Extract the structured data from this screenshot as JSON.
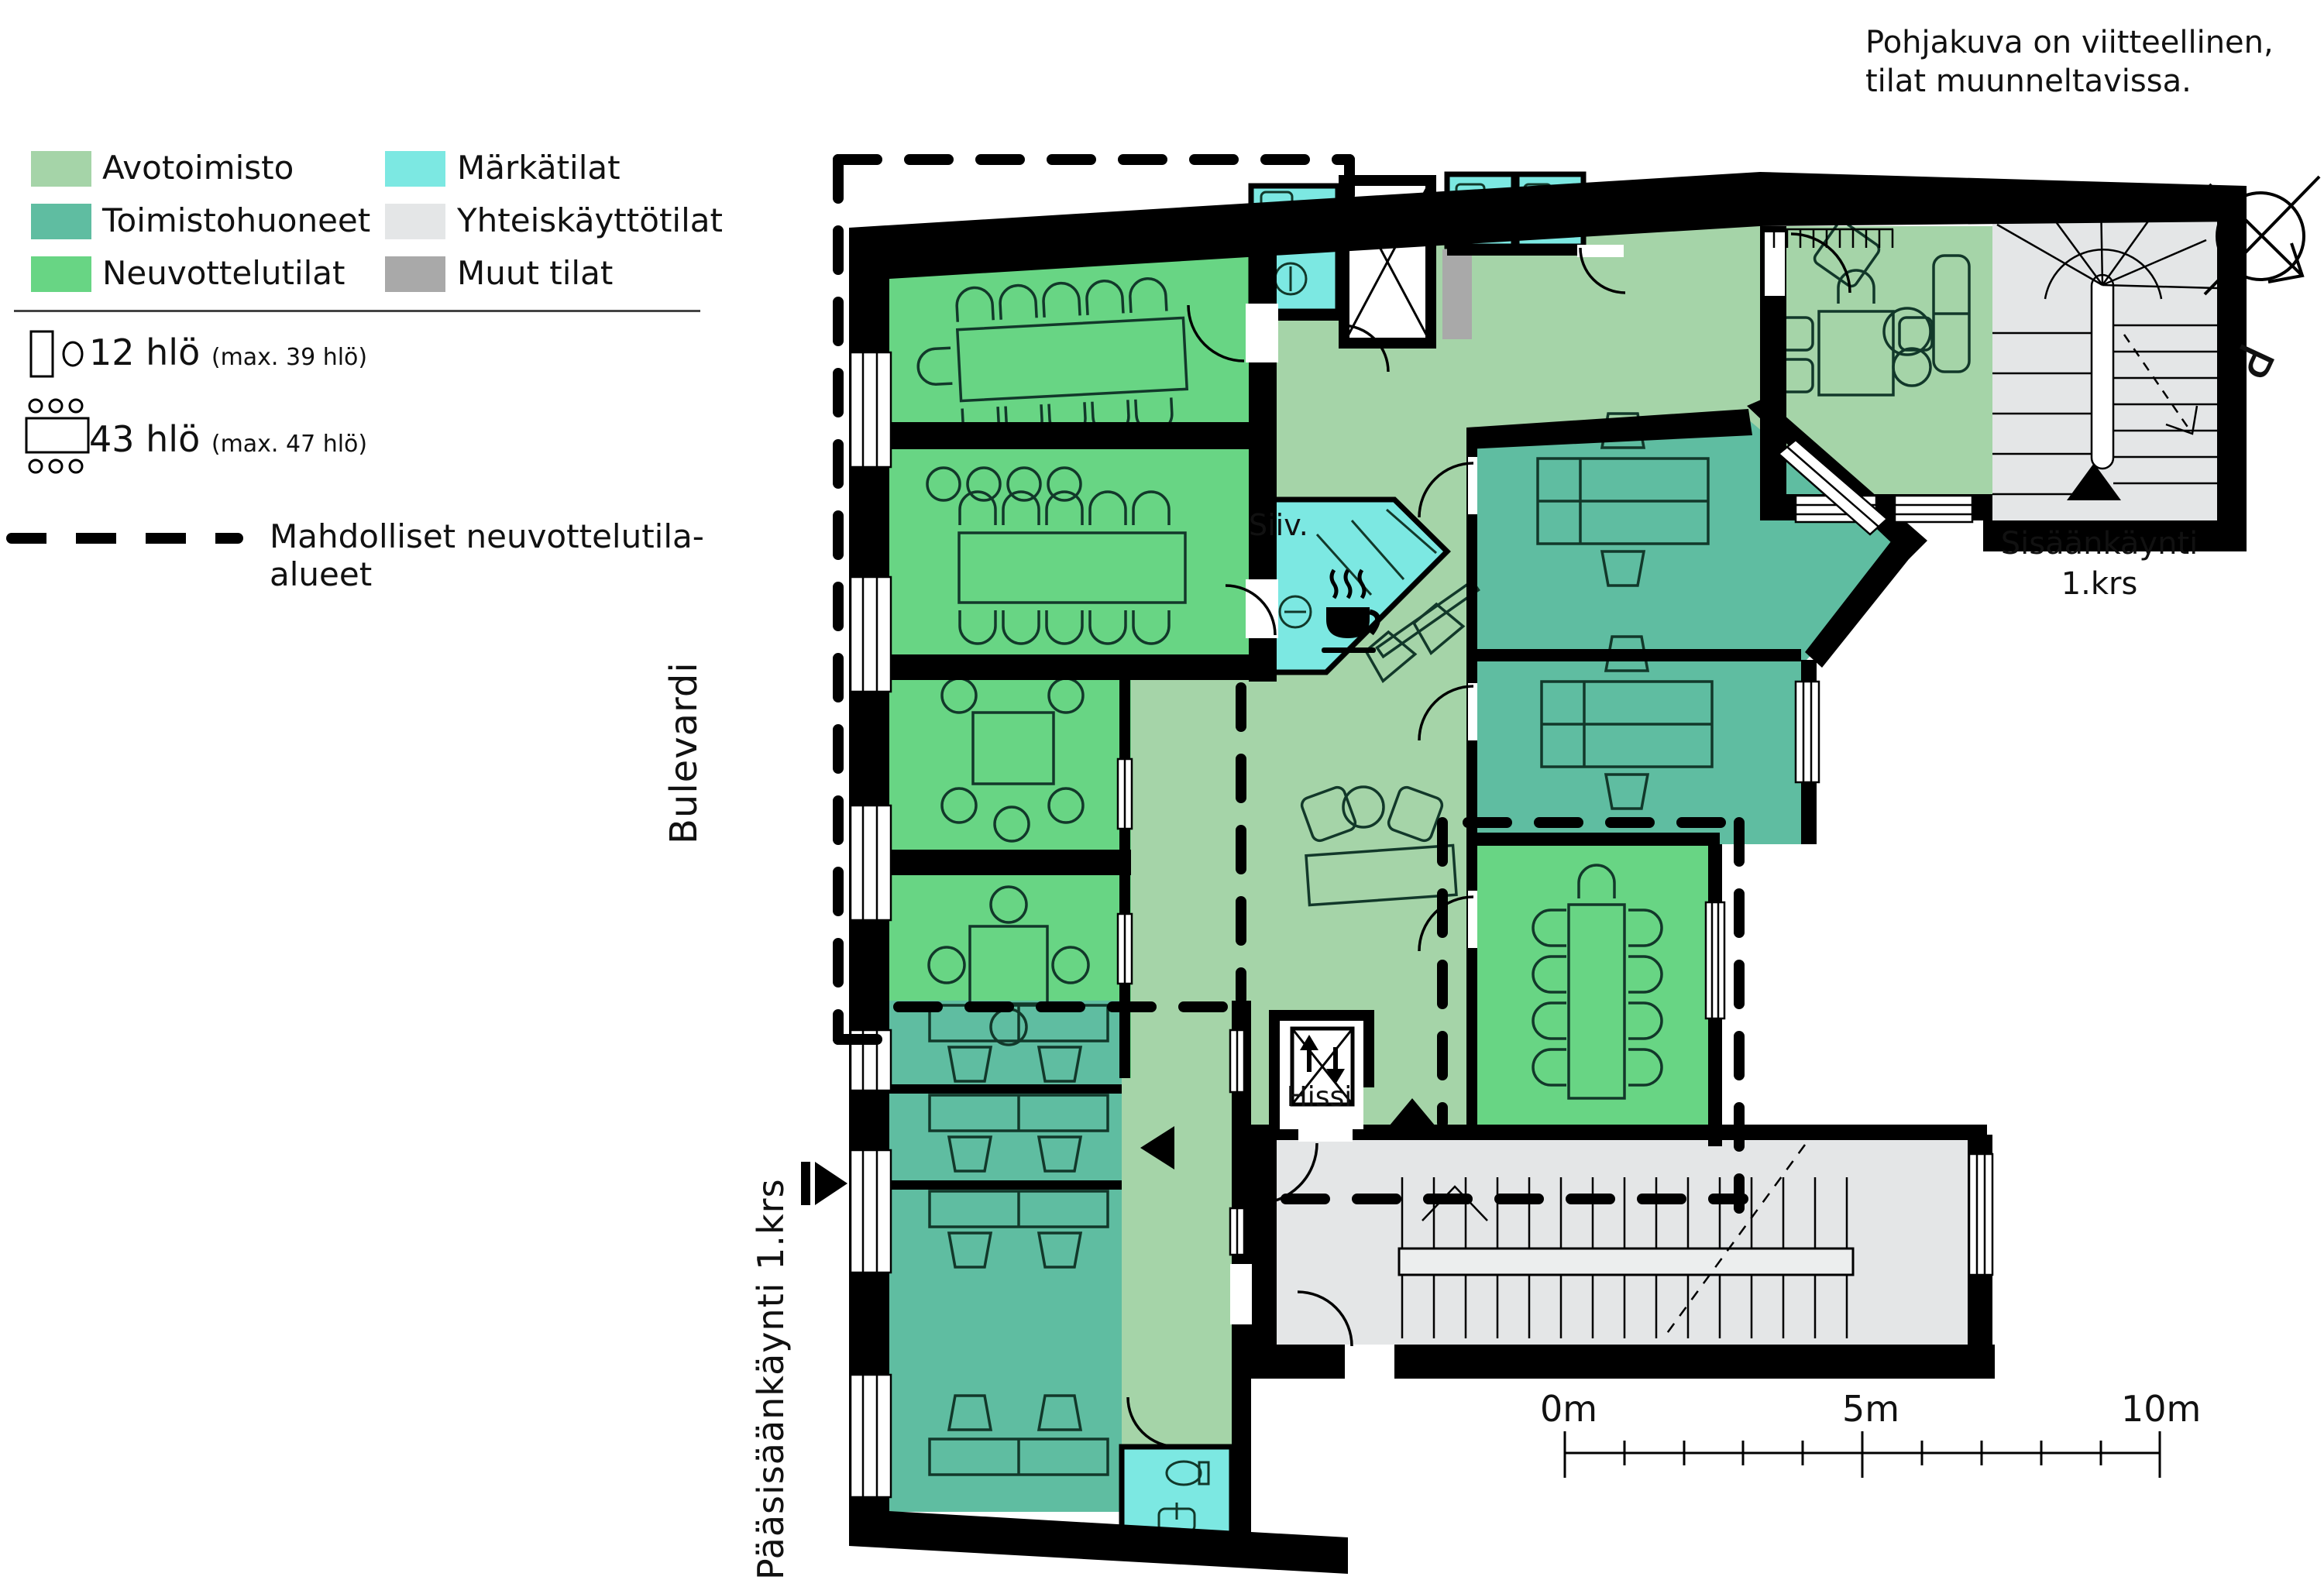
{
  "disclaimer": "Pohjakuva on viitteellinen, tilat muunneltavissa.",
  "legend": {
    "items": [
      {
        "label": "Avotoimisto",
        "color": "#a5d4a8"
      },
      {
        "label": "Toimistohuoneet",
        "color": "#5fbda1"
      },
      {
        "label": "Neuvottelutilat",
        "color": "#68d584"
      },
      {
        "label": "Märkätilat",
        "color": "#7ce8e2"
      },
      {
        "label": "Yhteiskäyttötilat",
        "color": "#e4e6e7"
      },
      {
        "label": "Muut tilat",
        "color": "#a9a9a9"
      }
    ],
    "capacity": [
      {
        "value": "12 hlö",
        "note": "(max. 39 hlö)"
      },
      {
        "value": "43 hlö",
        "note": "(max. 47 hlö)"
      }
    ],
    "dashed_label": "Mahdolliset neuvottelutila-alueet"
  },
  "labels": {
    "street": "Bulevardi",
    "main_entrance": "Pääsisäänkäynti 1.krs",
    "entrance_line1": "Sisäänkäynti",
    "entrance_line2": "1.krs",
    "elevator": "Hissi",
    "cleaning": "Siiv.",
    "north": "P"
  },
  "scalebar": {
    "labels": [
      "0m",
      "5m",
      "10m"
    ]
  },
  "colors": {
    "walls": "#000000",
    "avotoimisto": "#a5d4a8",
    "toimistohuoneet": "#5fbda1",
    "neuvottelutilat": "#68d584",
    "markatilat": "#7ce8e2",
    "yhteiskayttotilat": "#e4e6e7",
    "muut_tilat": "#a9a9a9",
    "furniture": "#12382a"
  }
}
